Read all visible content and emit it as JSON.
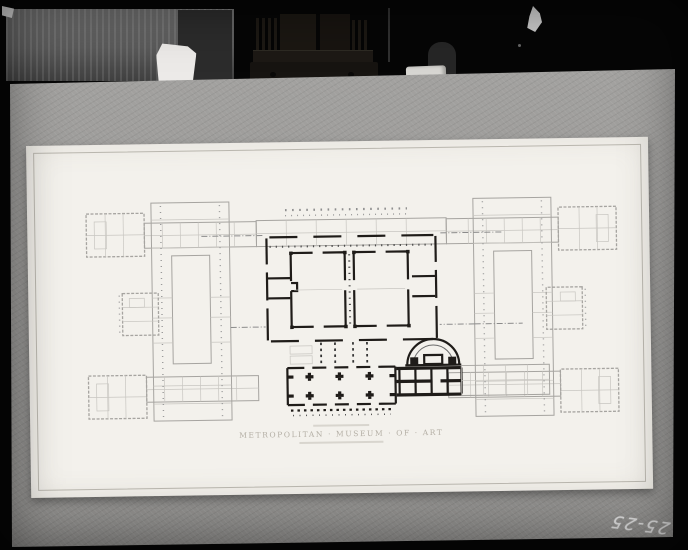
{
  "caption": {
    "title": "METROPOLITAN · MUSEUM · OF · ART"
  },
  "handwriting": {
    "negative_number": "25-25"
  },
  "colors": {
    "backdrop": "#060606",
    "board": "#9b9a98",
    "paper": "#f3f1ec",
    "paper_border": "#b9b6ae",
    "ink_dark": "#1f1c19",
    "ink_light": "#a6a4a0",
    "ink_lighter": "#c8c6c1",
    "caption_text": "#b3aea4",
    "handwriting_ink": "#dcdcdc"
  }
}
